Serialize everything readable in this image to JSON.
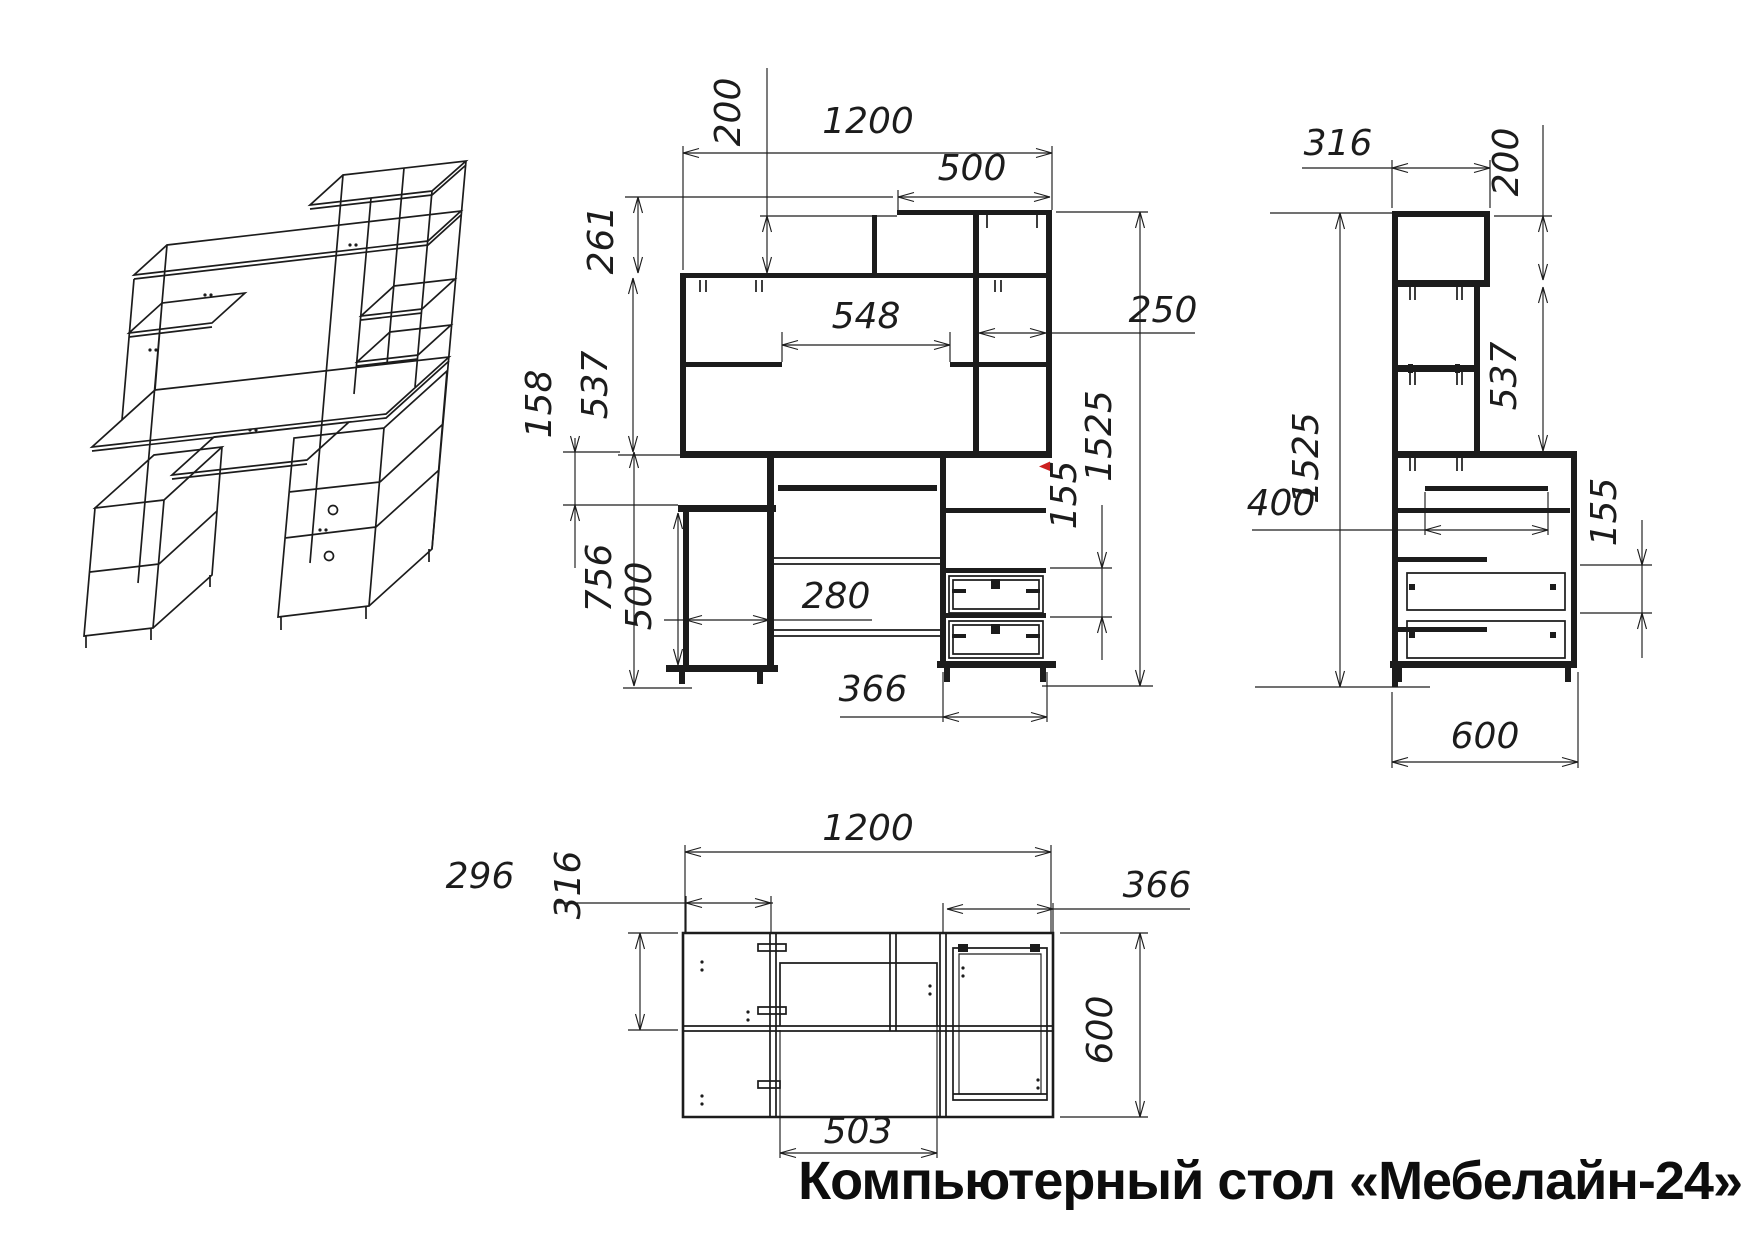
{
  "title": "Компьютерный стол «Мебелайн-24»",
  "views": {
    "front": {
      "dims": {
        "total_width": "1200",
        "top_shelf_width": "500",
        "top_shelf_height": "200",
        "shelf_drop": "261",
        "hutch_height": "537",
        "under_desktop_gap": "158",
        "niche_width": "548",
        "desk_height": "756",
        "cabinet_height": "500",
        "cabinet_width": "280",
        "pedestal_width": "366",
        "tower_width": "250",
        "drawer_spacing": "155",
        "total_height": "1525"
      }
    },
    "side": {
      "dims": {
        "top_shelf_depth": "316",
        "top_shelf_height": "200",
        "hutch_height": "537",
        "tray_depth": "400",
        "total_height": "1525",
        "drawer_spacing": "155",
        "desk_depth": "600"
      }
    },
    "top": {
      "dims": {
        "total_width": "1200",
        "left_section_width": "296",
        "hutch_depth": "316",
        "pedestal_width": "366",
        "desk_depth": "600",
        "tray_width": "503"
      }
    }
  },
  "colors": {
    "line": "#1c1c1c",
    "background": "#ffffff",
    "marker": "#cc2020"
  }
}
